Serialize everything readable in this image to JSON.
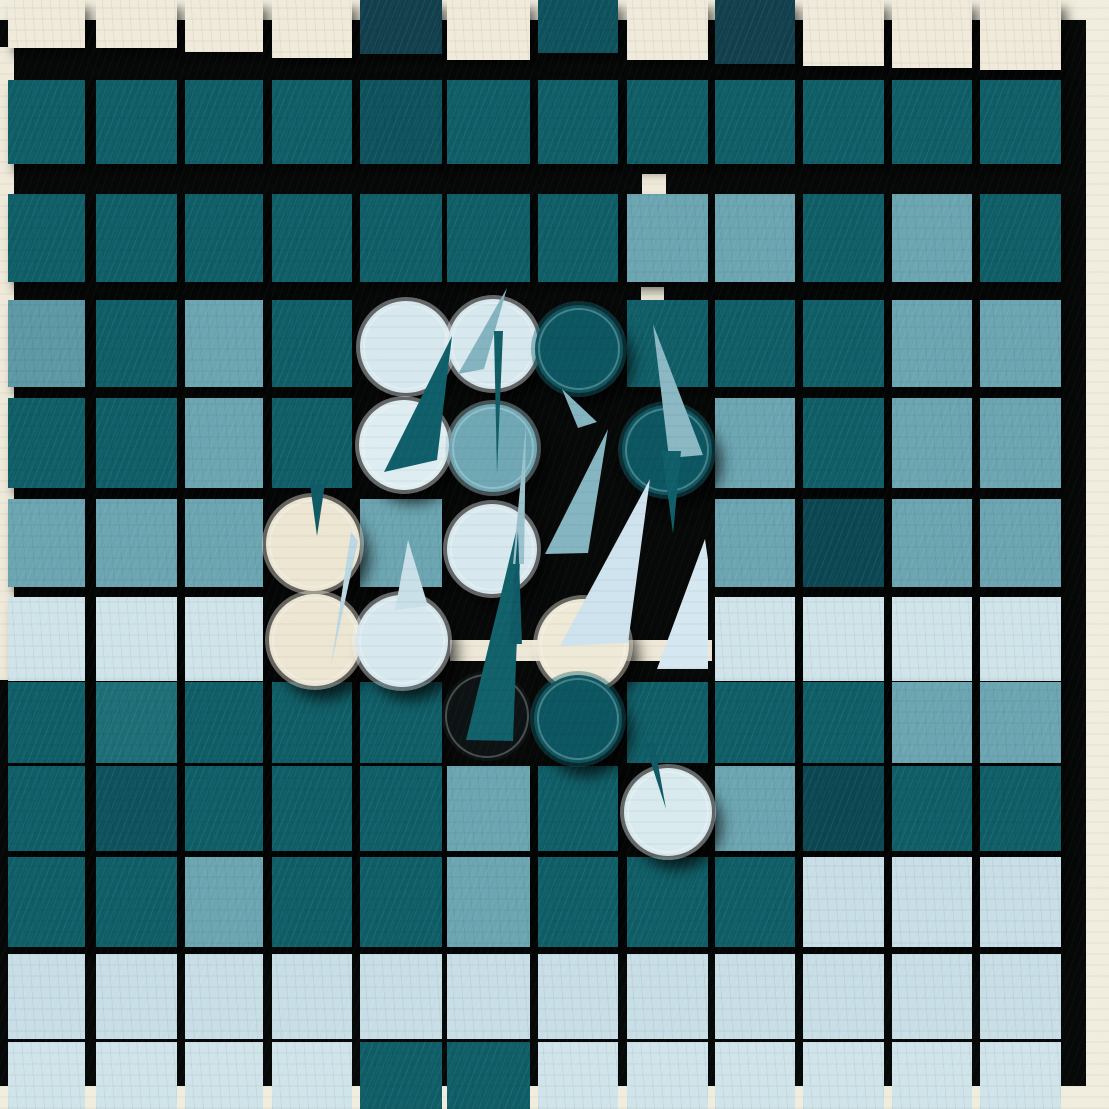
{
  "meta": {
    "title": "Abstract painted game board, 12x12 tiles with disc pieces and sail markers"
  },
  "palette": {
    "page_cream": "#F1EDDE",
    "board_black": "#070808",
    "CR": "#EFEADA",
    "NV": "#123F4D",
    "DKA": "#0F5E67",
    "DKB": "#0D525D",
    "ND": "#0B4752",
    "MD": "#1E6E77",
    "ST": "#6BA5B1",
    "STD": "#5C98A5",
    "PL": "#C8DEE6",
    "PLL": "#CFE4EA",
    "sail_dark": "#0F5F6A",
    "sail_steel": "#84B4C0",
    "sail_pale": "#CFE3EE",
    "sail_pale_dim": "#BCD8E3",
    "cream_bar": "#EDE8D7",
    "shadow_disc": "#0D1314"
  },
  "board": {
    "x": 0,
    "y": 20,
    "w": 1086,
    "h": 1066
  },
  "left_strip": {
    "x": 0,
    "y": 47,
    "w": 14,
    "h": 633
  },
  "columns": [
    [
      8,
      77
    ],
    [
      96,
      81
    ],
    [
      185,
      78
    ],
    [
      272,
      80
    ],
    [
      360,
      82
    ],
    [
      447,
      83
    ],
    [
      538,
      80
    ],
    [
      627,
      81
    ],
    [
      715,
      80
    ],
    [
      803,
      81
    ],
    [
      892,
      80
    ],
    [
      980,
      81
    ]
  ],
  "rows": [
    {
      "y": 0,
      "h": 56,
      "hs": [
        48,
        48,
        52,
        58,
        54,
        60,
        53,
        60,
        64,
        66,
        68,
        70
      ],
      "cells": [
        "CR",
        "CR",
        "CR",
        "CR",
        "NV",
        "CR",
        "DKB",
        "CR",
        "NV",
        "CR",
        "CR",
        "CR"
      ]
    },
    {
      "y": 80,
      "h": 84,
      "cells": [
        "DKA",
        "DKA",
        "DKA",
        "DKA",
        "DKB",
        "DKA",
        "DKA",
        "DKA",
        "DKA",
        "DKA",
        "DKA",
        "DKA"
      ]
    },
    {
      "y": 194,
      "h": 88,
      "cells": [
        "DKA",
        "DKA",
        "DKA",
        "DKA",
        "DKA",
        "DKA",
        "DKA",
        "ST",
        "ST",
        "DKA",
        "ST",
        "DKA"
      ]
    },
    {
      "y": 300,
      "h": 87,
      "cells": [
        "STD",
        "DKA",
        "ST",
        "DKA",
        null,
        null,
        null,
        "DKA",
        "DKA",
        "DKA",
        "ST",
        "ST"
      ]
    },
    {
      "y": 398,
      "h": 90,
      "cells": [
        "DKA",
        "DKA",
        "ST",
        "DKA",
        null,
        null,
        null,
        null,
        "ST",
        "DKA",
        "ST",
        "ST"
      ]
    },
    {
      "y": 499,
      "h": 88,
      "cells": [
        "ST",
        "ST",
        "ST",
        null,
        "ST",
        null,
        null,
        null,
        "ST",
        "ND",
        "ST",
        "ST"
      ]
    },
    {
      "y": 597,
      "h": 84,
      "cells": [
        "PLL",
        "PLL",
        "PLL",
        null,
        null,
        null,
        null,
        null,
        "PLL",
        "PLL",
        "PLL",
        "PLL"
      ]
    },
    {
      "y": 682,
      "h": 81,
      "cells": [
        "DKA",
        "MD",
        "DKA",
        "DKA",
        "DKA",
        null,
        null,
        "DKA",
        "DKA",
        "DKA",
        "ST",
        "ST"
      ]
    },
    {
      "y": 766,
      "h": 85,
      "cells": [
        "DKA",
        "DKB",
        "DKA",
        "DKA",
        "DKA",
        "ST",
        "DKA",
        null,
        "ST",
        "ND",
        "DKA",
        "DKA"
      ]
    },
    {
      "y": 857,
      "h": 90,
      "cells": [
        "DKA",
        "DKA",
        "ST",
        "DKA",
        "DKA",
        "ST",
        "DKA",
        "DKA",
        "DKA",
        "PL",
        "PL",
        "PL"
      ]
    },
    {
      "y": 954,
      "h": 85,
      "cells": [
        "PL",
        "PL",
        "PL",
        "PL",
        "PL",
        "PL",
        "PL",
        "PL",
        "PL",
        "PL",
        "PL",
        "PL"
      ]
    },
    {
      "y": 1042,
      "h": 67,
      "cells": [
        "PLL",
        "PLL",
        "PLL",
        "PLL",
        "DKA",
        "DKA",
        "PLL",
        "PLL",
        "PLL",
        "PLL",
        "PLL",
        "PLL"
      ]
    }
  ],
  "cream_peeks": [
    {
      "x": 641,
      "y": 87,
      "w": 24,
      "h": 12
    },
    {
      "x": 642,
      "y": 174,
      "w": 24,
      "h": 29
    },
    {
      "x": 641,
      "y": 287,
      "w": 23,
      "h": 17
    }
  ],
  "cream_bar": {
    "x": 450,
    "y": 640,
    "w": 262,
    "h": 21
  },
  "shadow_circle": {
    "cx": 487,
    "cy": 716,
    "r": 45
  },
  "circles": [
    {
      "id": "disc-pale-1",
      "cx": 406,
      "cy": 347,
      "r": 46,
      "fill": "#D7E8EE",
      "ring": "#F2F8FA"
    },
    {
      "id": "disc-pale-2",
      "cx": 493,
      "cy": 344,
      "r": 45,
      "fill": "#D7E8EE",
      "ring": "#F2F8FA"
    },
    {
      "id": "disc-dark-3",
      "cx": 579,
      "cy": 349,
      "r": 44,
      "fill": "#0C5661",
      "ring": "#1A6872"
    },
    {
      "id": "disc-pale-4",
      "cx": 404,
      "cy": 445,
      "r": 45,
      "fill": "#DEEDF1",
      "ring": "#F4FAFB"
    },
    {
      "id": "disc-steel-5",
      "cx": 493,
      "cy": 448,
      "r": 44,
      "fill": "#6FA8B4",
      "ring": "#A8CBD3"
    },
    {
      "id": "disc-dark-6",
      "cx": 667,
      "cy": 450,
      "r": 45,
      "fill": "#0C5661",
      "ring": "#1A6872"
    },
    {
      "id": "disc-cream-7",
      "cx": 313,
      "cy": 544,
      "r": 47,
      "fill": "#ECE6D3",
      "ring": "#F7F3E6"
    },
    {
      "id": "disc-pale-8",
      "cx": 492,
      "cy": 549,
      "r": 45,
      "fill": "#D7E8EE",
      "ring": "#F2F8FA"
    },
    {
      "id": "disc-cream-9",
      "cx": 315,
      "cy": 640,
      "r": 46,
      "fill": "#ECE6D3",
      "ring": "#F7F3E6"
    },
    {
      "id": "disc-pale-10",
      "cx": 402,
      "cy": 641,
      "r": 46,
      "fill": "#D7E8EE",
      "ring": "#F2F8FA"
    },
    {
      "id": "disc-cream-11",
      "cx": 583,
      "cy": 645,
      "r": 46,
      "fill": "#EFE9D8",
      "ring": "#F7F3E6"
    },
    {
      "id": "disc-dark-12",
      "cx": 578,
      "cy": 719,
      "r": 44,
      "fill": "#0C5661",
      "ring": "#15626C"
    },
    {
      "id": "disc-pale-13",
      "cx": 668,
      "cy": 812,
      "r": 44,
      "fill": "#D9EAEF",
      "ring": "#F4FAFB"
    }
  ],
  "sails": [
    {
      "id": "sail-dark-left-big",
      "points": "452,336 384,472 437,460",
      "fill": "#0F5F6A"
    },
    {
      "id": "sail-steel-on-disc2",
      "points": "507,288 458,374 484,369",
      "fill": "#84B4C0"
    },
    {
      "id": "needle-dark-disc2",
      "points": "494,331 503,331 497,474",
      "fill": "#115E66"
    },
    {
      "id": "sail-steel-on-disc6",
      "points": "653,324 669,458 703,455",
      "fill": "#8BB8C3"
    },
    {
      "id": "needle-dark-under-disc6",
      "points": "662,451 681,451 673,534",
      "fill": "#0F5F6A"
    },
    {
      "id": "sail-steel-small",
      "points": "562,389 578,428 597,422",
      "fill": "#84B4C0"
    },
    {
      "id": "sail-steel-big",
      "points": "608,429 545,554 588,553",
      "fill": "#85B5C1"
    },
    {
      "id": "sail-pale-big",
      "points": "650,479 560,646 628,643",
      "fill": "#CFE3EE"
    },
    {
      "id": "sail-pale-right",
      "points": "705,539 657,669 708,669 708,560",
      "fill": "#D5E7F0"
    },
    {
      "id": "sail-dark-center-big",
      "points": "522,507 466,740 513,741",
      "fill": "#11616B"
    },
    {
      "id": "needle-steel-thin",
      "points": "526,424 513,564 524,564",
      "fill": "#9CC2CC"
    },
    {
      "id": "needle-dark-thin",
      "points": "518,531 509,644 522,644",
      "fill": "#0F5A66"
    },
    {
      "id": "needle-on-cream-disc7",
      "points": "310,484 325,484 317,536",
      "fill": "#0F5A66"
    },
    {
      "id": "needle-pale-on-disc9",
      "points": "351,532 358,541 331,666",
      "fill": "#BCD8E3"
    },
    {
      "id": "sail-pale-above-disc10",
      "points": "408,540 395,610 428,606",
      "fill": "#C9E0E8"
    },
    {
      "id": "needle-on-disc13",
      "points": "645,744 654,741 666,809",
      "fill": "#0F5A66"
    }
  ]
}
